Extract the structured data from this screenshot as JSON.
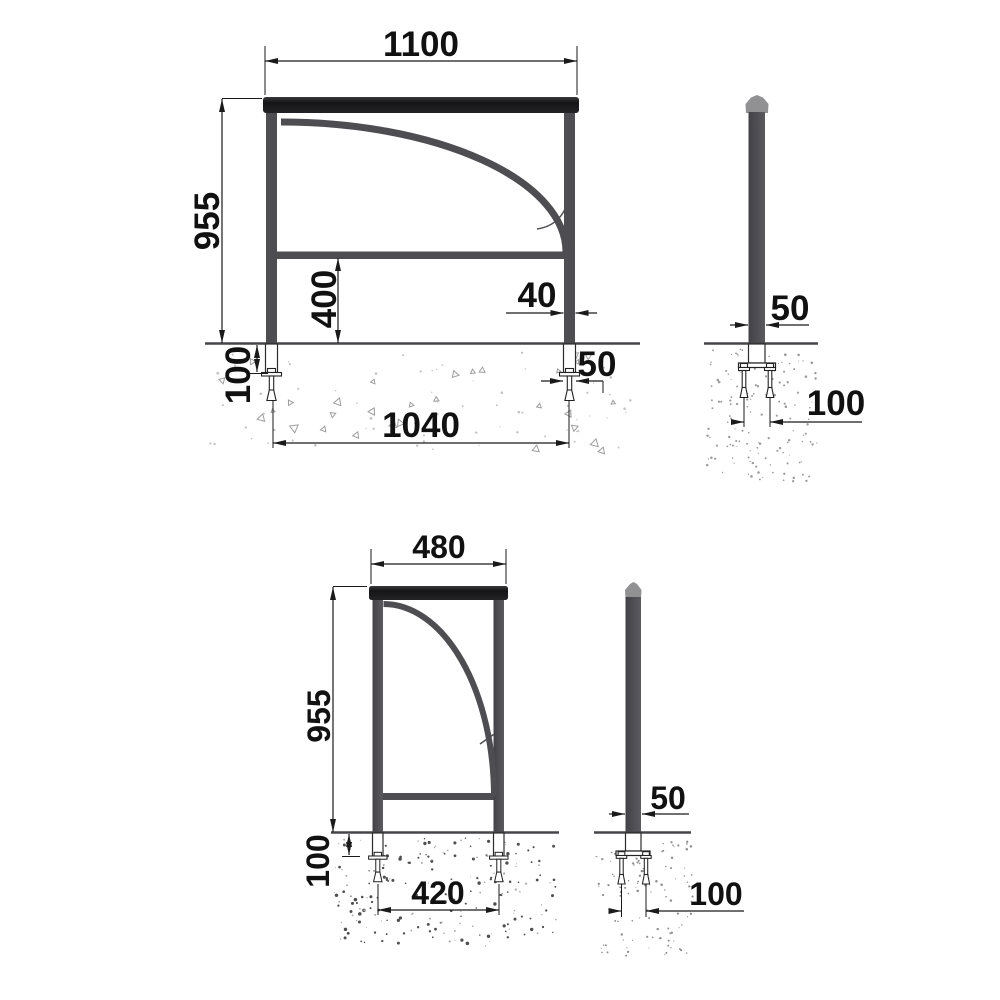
{
  "drawing_type": "technical-dimension-drawing",
  "subject": "steel barrier / railing with anchor fixing, front and side views",
  "colors": {
    "background": "#ffffff",
    "steel": "#4d4d52",
    "top_bar": "#1d1d20",
    "post_cap": "#919194",
    "dimension_lines": "#1a1a1a",
    "concrete_speckle_light": "#9e9e9e",
    "concrete_speckle_dark": "#4f4f4f"
  },
  "figures": {
    "front_large": {
      "name": "front view - wide barrier",
      "dims": {
        "overall_width": "1100",
        "overall_height": "955",
        "rail_height": "400",
        "post_width": "40",
        "anchor_width": "50",
        "embed_depth": "100",
        "anchor_spacing": "1040"
      }
    },
    "side_large": {
      "name": "side view - post with anchor",
      "dims": {
        "post_depth": "50",
        "bolt_spacing": "100"
      }
    },
    "front_small": {
      "name": "front view - narrow barrier",
      "dims": {
        "overall_width": "480",
        "overall_height": "955",
        "embed_depth": "100",
        "anchor_spacing": "420"
      }
    },
    "side_small": {
      "name": "side view - post with anchor",
      "dims": {
        "post_depth": "50",
        "bolt_spacing": "100"
      }
    }
  }
}
